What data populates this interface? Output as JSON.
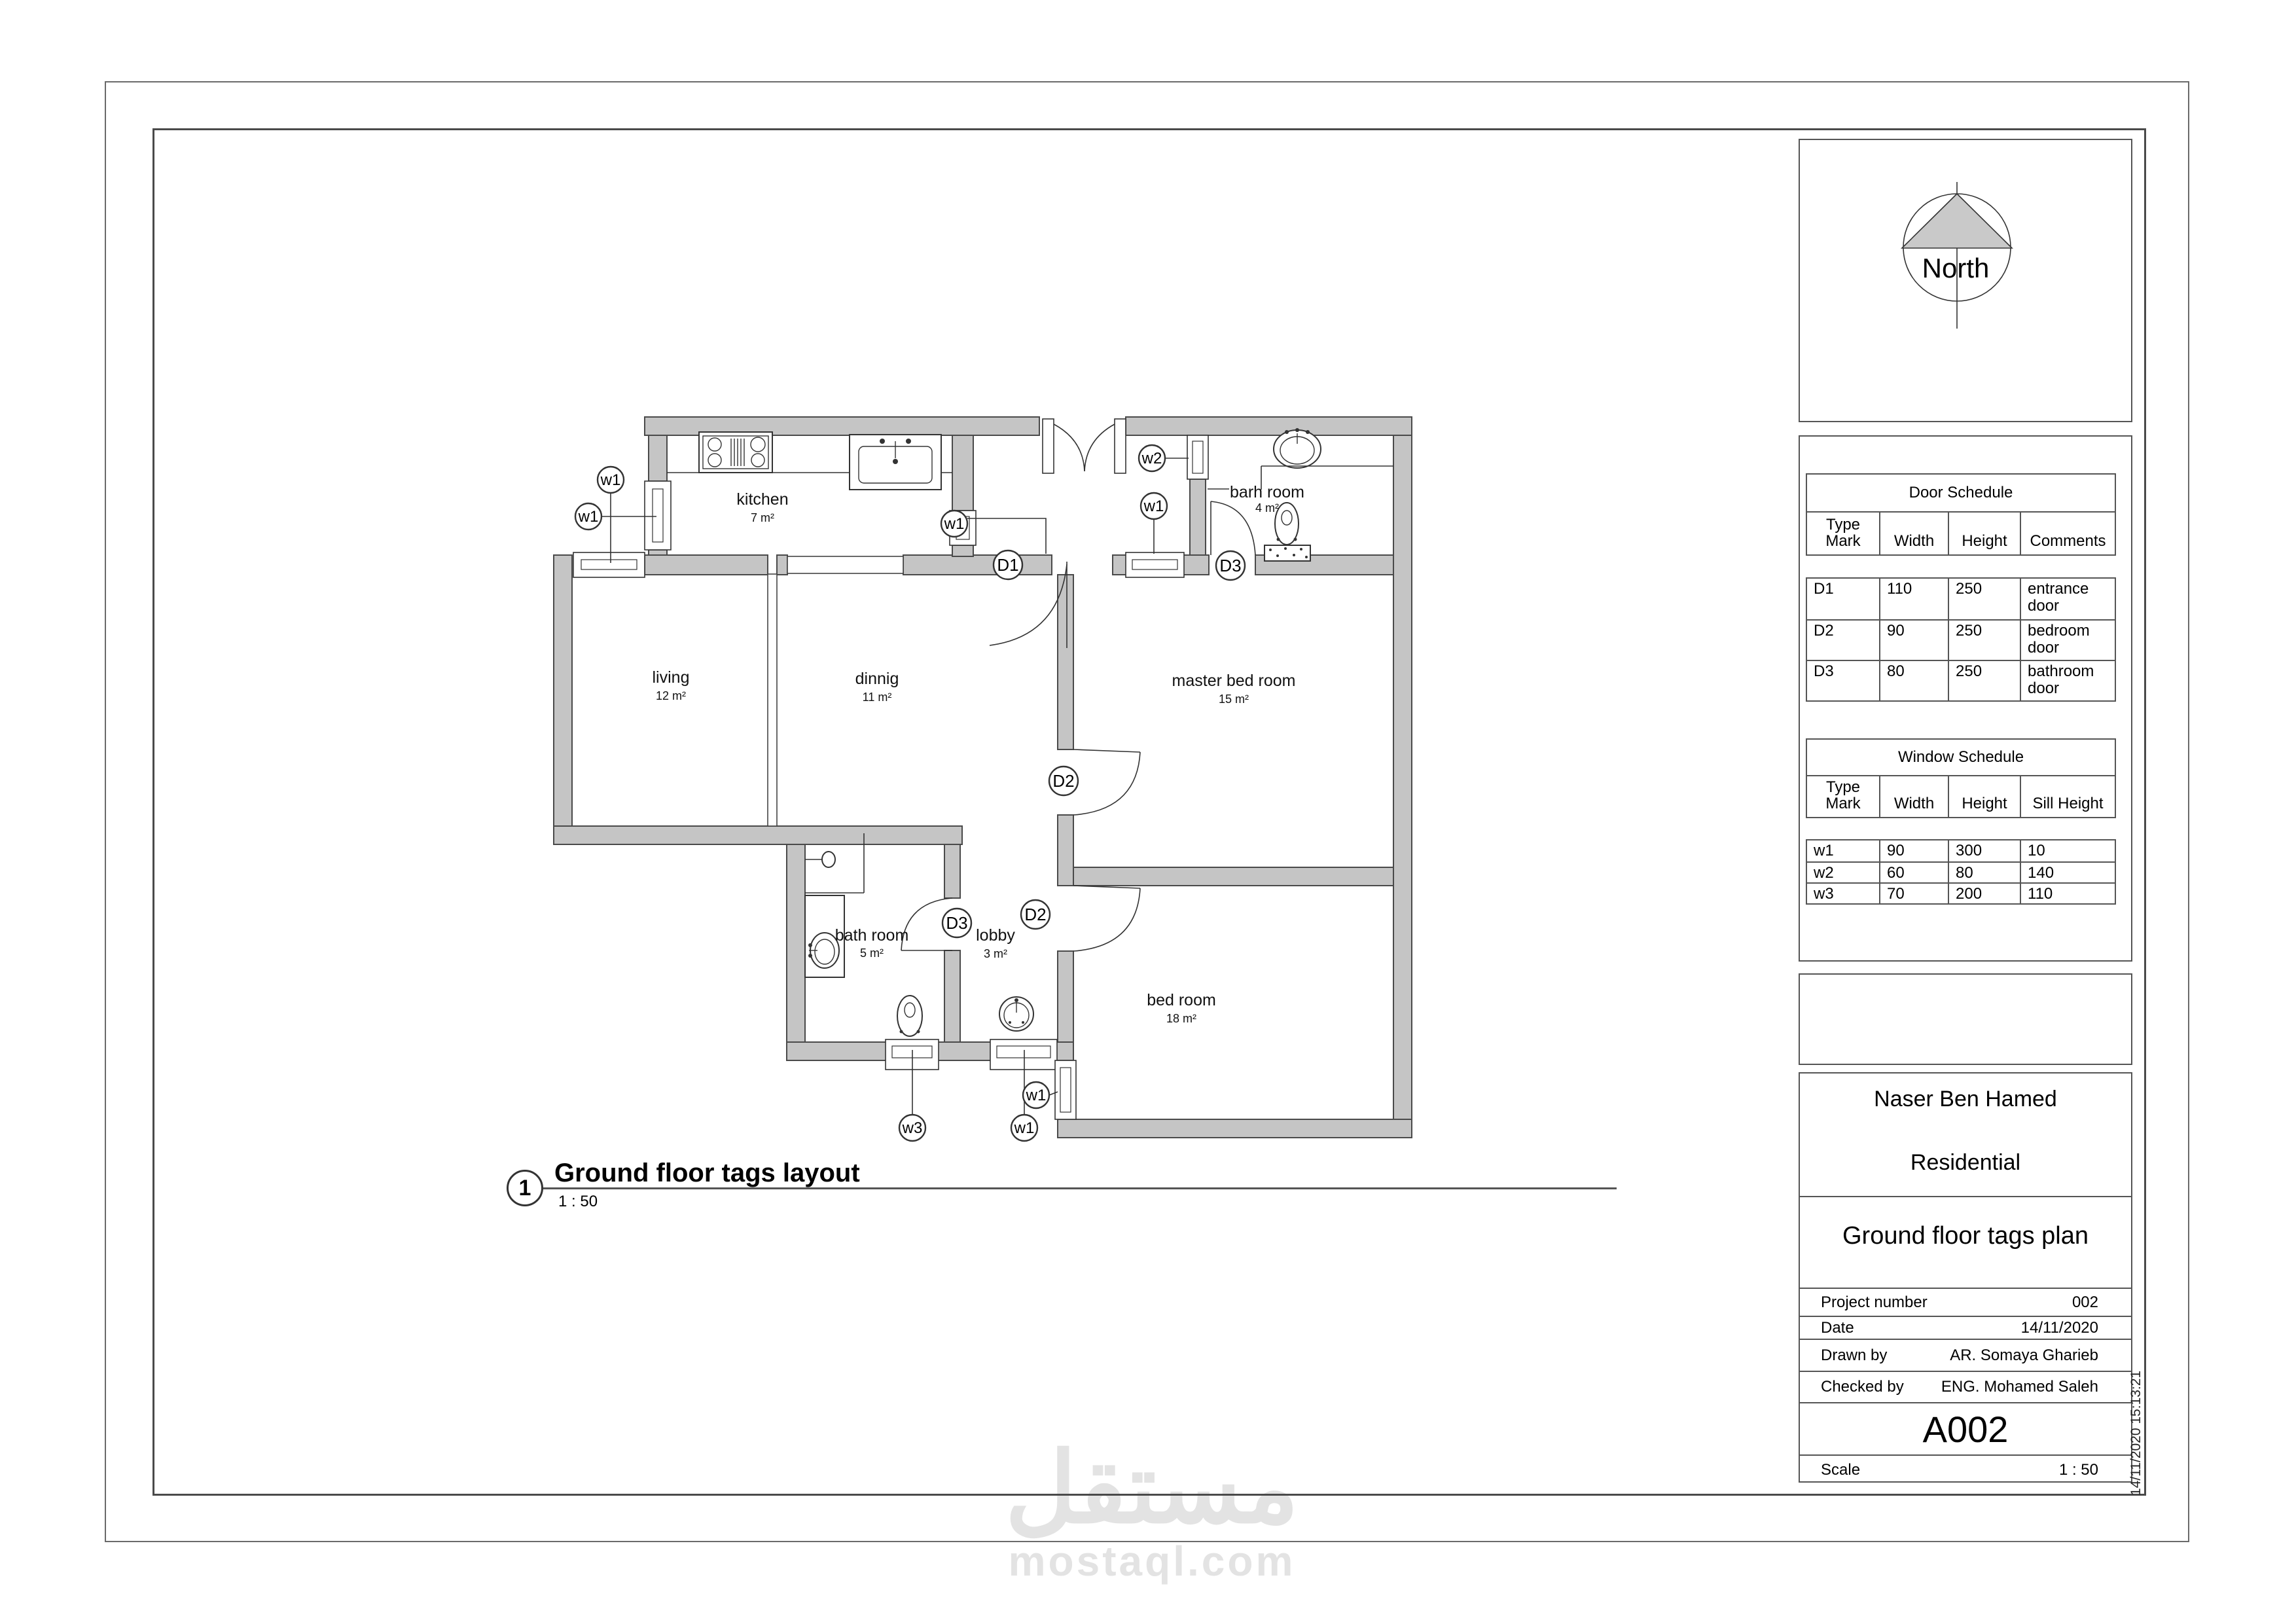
{
  "sheet": {
    "view_number": "1",
    "view_title": "Ground floor tags layout",
    "view_scale": "1 : 50",
    "timestamp": "14/11/2020 15:13:21"
  },
  "north": {
    "label": "North"
  },
  "door_schedule": {
    "title": "Door Schedule",
    "headers": [
      "Type Mark",
      "Width",
      "Height",
      "Comments"
    ],
    "rows": [
      {
        "mark": "D1",
        "width": "110",
        "height": "250",
        "comments": "entrance door"
      },
      {
        "mark": "D2",
        "width": "90",
        "height": "250",
        "comments": "bedroom door"
      },
      {
        "mark": "D3",
        "width": "80",
        "height": "250",
        "comments": "bathroom door"
      }
    ]
  },
  "window_schedule": {
    "title": "Window Schedule",
    "headers": [
      "Type Mark",
      "Width",
      "Height",
      "Sill Height"
    ],
    "rows": [
      {
        "mark": "w1",
        "width": "90",
        "height": "300",
        "sill": "10"
      },
      {
        "mark": "w2",
        "width": "60",
        "height": "80",
        "sill": "140"
      },
      {
        "mark": "w3",
        "width": "70",
        "height": "200",
        "sill": "110"
      }
    ]
  },
  "title_block": {
    "owner": "Naser Ben Hamed",
    "project": "Residential",
    "sheet_name": "Ground floor tags plan",
    "fields": [
      {
        "label": "Project number",
        "value": "002"
      },
      {
        "label": "Date",
        "value": "14/11/2020"
      },
      {
        "label": "Drawn by",
        "value": "AR. Somaya Gharieb"
      },
      {
        "label": "Checked by",
        "value": "ENG. Mohamed Saleh"
      }
    ],
    "sheet_number": "A002",
    "scale_label": "Scale",
    "scale_value": "1 : 50"
  },
  "plan": {
    "rooms": [
      {
        "name": "kitchen",
        "area": "7 m²"
      },
      {
        "name": "living",
        "area": "12 m²"
      },
      {
        "name": "dinnig",
        "area": "11 m²"
      },
      {
        "name": "master bed room",
        "area": "15 m²"
      },
      {
        "name": "barh room",
        "area": "4 m²"
      },
      {
        "name": "bath room",
        "area": "5 m²"
      },
      {
        "name": "lobby",
        "area": "3 m²"
      },
      {
        "name": "bed room",
        "area": "18 m²"
      }
    ],
    "tags": {
      "w1": "w1",
      "w2": "w2",
      "w3": "w3",
      "d1": "D1",
      "d2": "D2",
      "d3": "D3"
    }
  },
  "watermark": {
    "arabic": "مستقل",
    "latin": "mostaql.com"
  }
}
